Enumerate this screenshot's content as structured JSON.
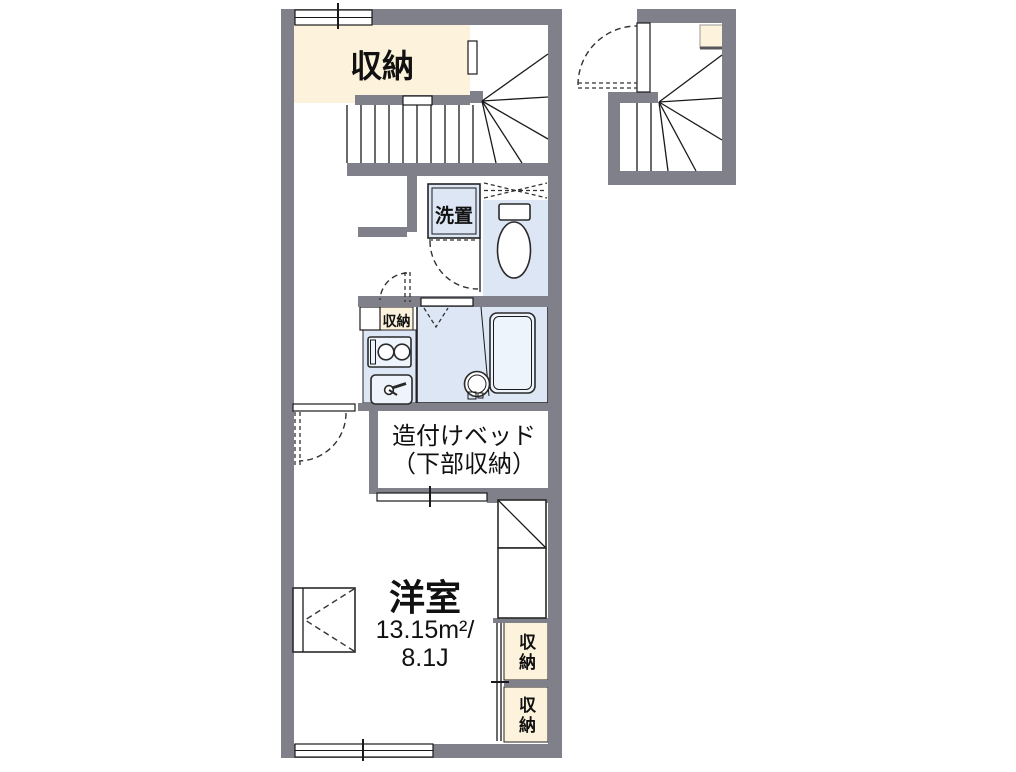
{
  "labels": {
    "storage_top": "収納",
    "laundry": "洗置",
    "storage_small": "収納",
    "bed_line1": "造付けベッド",
    "bed_line2": "（下部収納）",
    "room_name": "洋室",
    "room_area": "13.15m²/",
    "room_size": "8.1J",
    "storage_right_upper": "収納",
    "storage_right_lower": "収納"
  },
  "colors": {
    "wall": "#80808A",
    "storage": "#FDF3DC",
    "water": "#DCE6F5",
    "outline": "#1A1A1A"
  }
}
